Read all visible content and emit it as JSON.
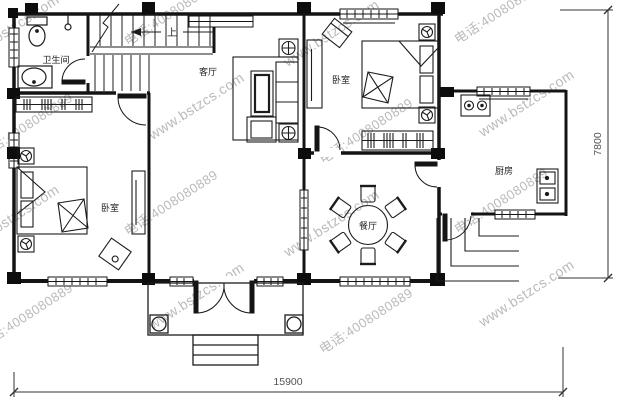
{
  "rooms": {
    "bathroom": "卫生间",
    "living_room": "客厅",
    "bedroom_top_right": "卧室",
    "bedroom_bottom_left": "卧室",
    "kitchen": "厨房",
    "dining_room": "餐厅",
    "stair_direction": "上"
  },
  "dimensions": {
    "bottom_width": "15900",
    "right_height": "7800"
  },
  "watermarks": {
    "site": "www.bstzcs.com",
    "phone": "电话:4008080889"
  },
  "colors": {
    "line": "#141414",
    "dim_text": "#555555",
    "watermark": "#a9a9a9"
  }
}
